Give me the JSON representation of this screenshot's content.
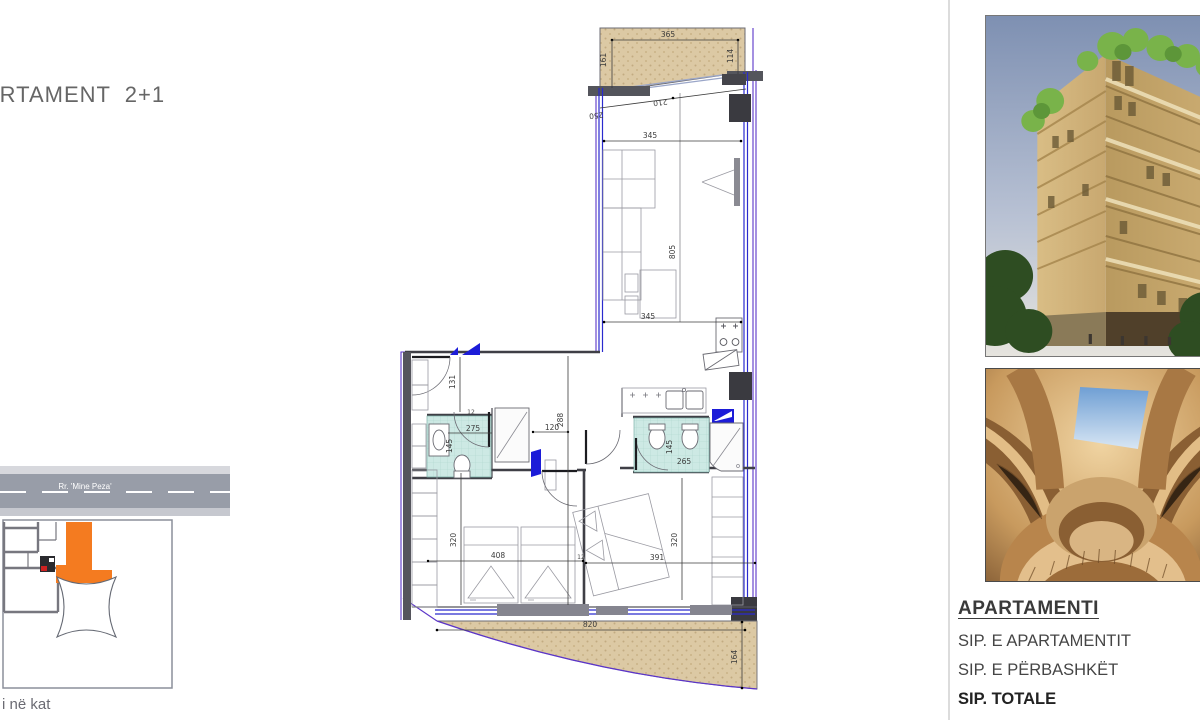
{
  "page": {
    "title": "ARTAMENT  2+1"
  },
  "site_plan": {
    "street_label": "Rr. 'Mine Peza'",
    "caption": "i në kat"
  },
  "floor_plan": {
    "dims": {
      "balcony_top_width": "365",
      "balcony_left_depth": "161",
      "balcony_right_depth": "114",
      "balcony_inner_width": "210",
      "left_offset": "250",
      "living_width": "345",
      "living_length": "805",
      "kitchen_width": "345",
      "entry_depth": "131",
      "bath1_width": "275",
      "bath1_depth": "145",
      "wall_a": "12",
      "hall_width": "120",
      "hall_depth": "288",
      "bath2_width": "265",
      "bath2_depth": "145",
      "bedroom1_depth": "320",
      "bedroom1_width": "408",
      "wall_b": "12",
      "bedroom2_depth": "320",
      "bedroom2_width": "391",
      "balcony_bottom_width": "820",
      "balcony_bottom_depth": "164"
    }
  },
  "sidebar": {
    "title": "APARTAMENTI",
    "rows": [
      {
        "label": "SIP. E APARTAMENTIT"
      },
      {
        "label": "SIP. E PËRBASHKËT"
      },
      {
        "label": "SIP. TOTALE"
      }
    ]
  },
  "colors": {
    "accent_orange": "#f47b20",
    "glazing_blue": "#2a2ace",
    "outline_purple": "#5b35c8",
    "balcony_sand": "#dcc9a4",
    "bath_teal": "#cde9e4",
    "road_gray": "#989da8"
  }
}
